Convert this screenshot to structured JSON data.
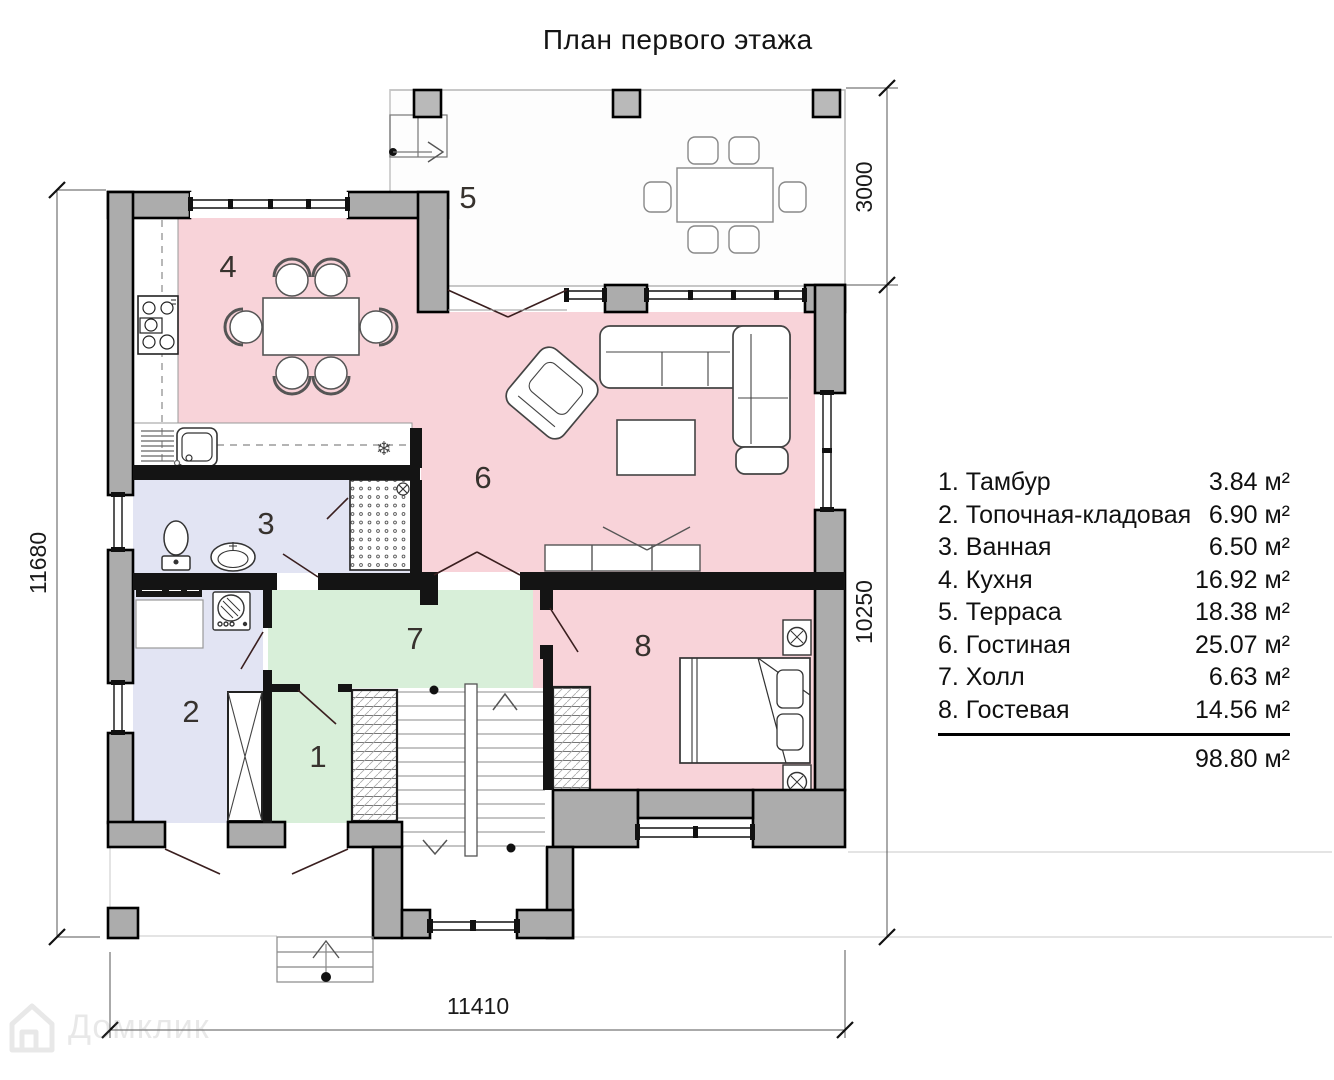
{
  "title": "План первого этажа",
  "legend": {
    "items": [
      {
        "label": "1. Тамбур",
        "area": "3.84 м²"
      },
      {
        "label": "2. Топочная-кладовая",
        "area": "6.90 м²"
      },
      {
        "label": "3. Ванная",
        "area": "6.50 м²"
      },
      {
        "label": "4. Кухня",
        "area": "16.92 м²"
      },
      {
        "label": "5. Терраса",
        "area": "18.38 м²"
      },
      {
        "label": "6. Гостиная",
        "area": "25.07 м²"
      },
      {
        "label": "7. Холл",
        "area": "6.63 м²"
      },
      {
        "label": "8. Гостевая",
        "area": "14.56 м²"
      }
    ],
    "total": "98.80 м²"
  },
  "plan": {
    "room_numbers": [
      "1",
      "2",
      "3",
      "4",
      "5",
      "6",
      "7",
      "8"
    ],
    "dimensions": {
      "left": "11680",
      "right_top": "3000",
      "right_bottom": "10250",
      "bottom": "11410"
    }
  },
  "icons": {
    "fridge": "❄"
  },
  "watermark": {
    "text": "Домклик"
  },
  "colors": {
    "room_pink": "#f8d3d9",
    "room_green": "#d8efd9",
    "room_lavender": "#e2e4f3",
    "wall_gray": "#acacac",
    "terrace_floor": "#fdfdfd"
  }
}
